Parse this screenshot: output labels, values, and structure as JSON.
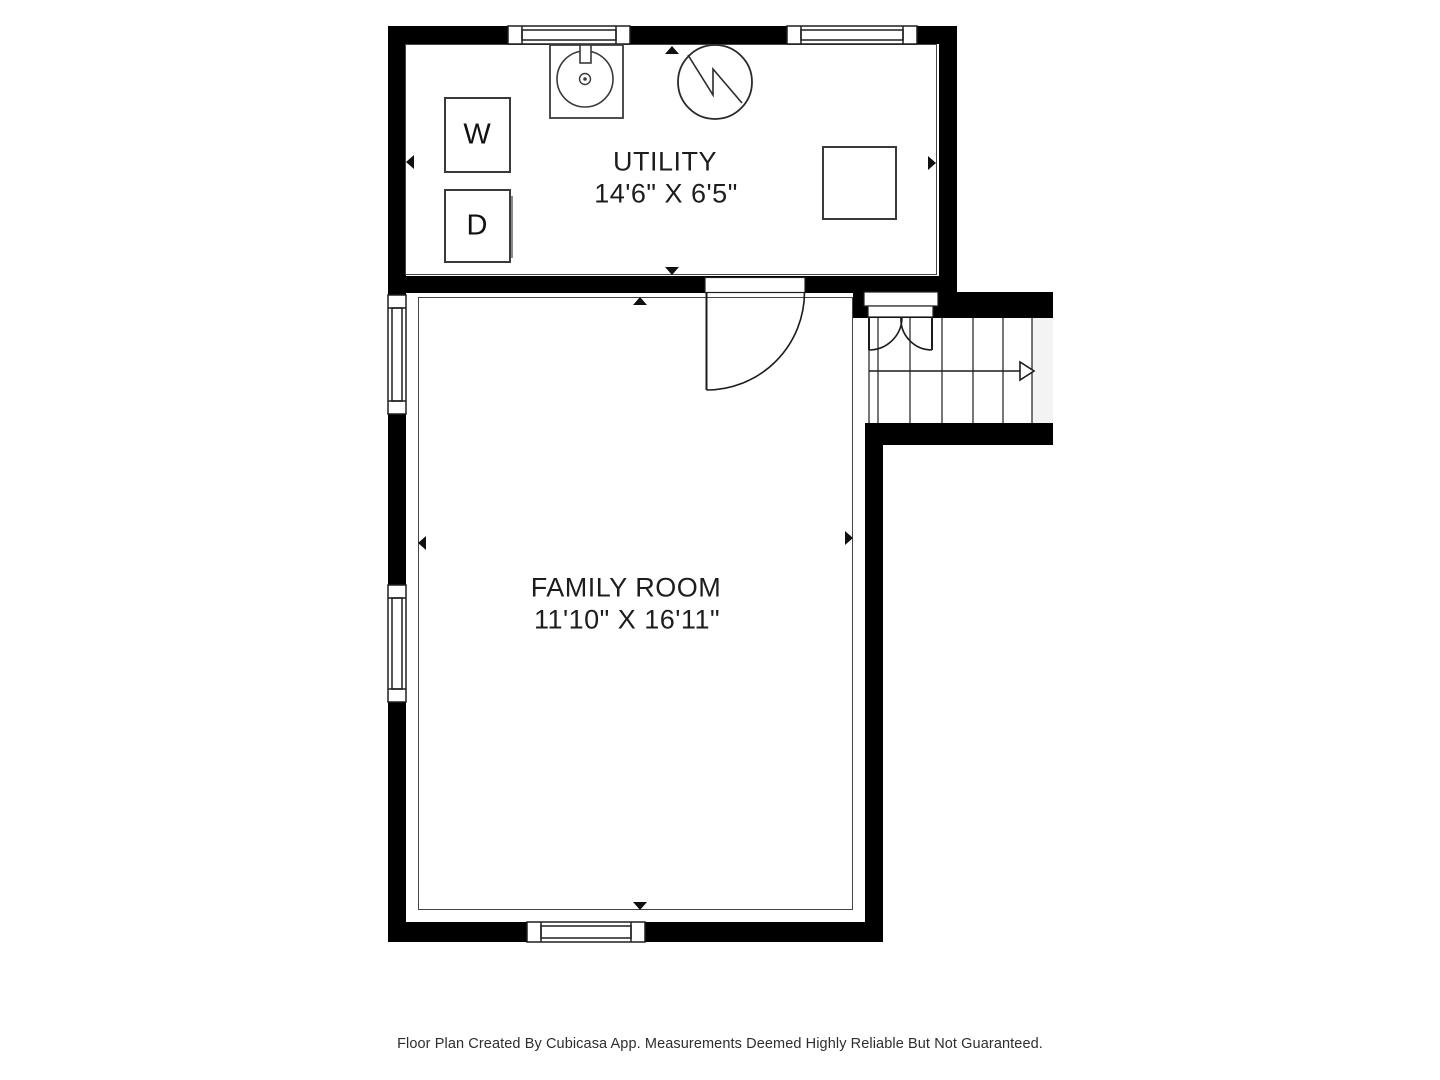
{
  "floor_plan": {
    "rooms": [
      {
        "name": "UTILITY",
        "dimensions": "14'6\" X 6'5\""
      },
      {
        "name": "FAMILY ROOM",
        "dimensions": "11'10\" X 16'11\""
      }
    ],
    "appliances": [
      {
        "label": "W"
      },
      {
        "label": "D"
      }
    ],
    "footer_note": "Floor Plan Created By Cubicasa App. Measurements Deemed Highly Reliable But Not Guaranteed.",
    "colors": {
      "wall": "#000000",
      "symbol_line": "#1c1c1c",
      "room_outline": "#454545",
      "stair_cut_fill": "#f3f3f3",
      "text": "#1d1d1d"
    }
  }
}
